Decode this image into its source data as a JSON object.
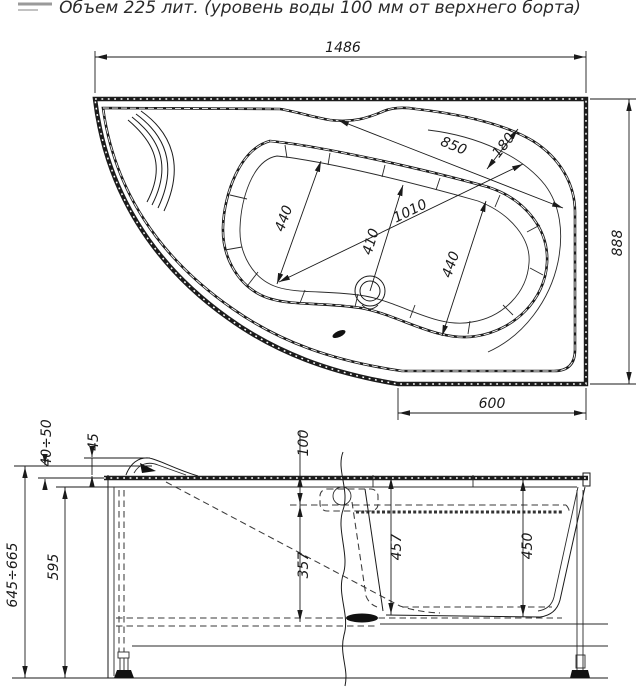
{
  "title": "Объем 225 лит. (уровень воды 100 мм от верхнего борта)",
  "top_view": {
    "dim_width": "1486",
    "dim_height": "888",
    "dim_bottom": "600",
    "dim_long_axis": "1010",
    "dim_diagonal": "850",
    "dim_rim": "180",
    "dim_upper_width": "440",
    "dim_lower_width": "440",
    "dim_drain": "410"
  },
  "side_view": {
    "dim_adjust_range": "40÷50",
    "dim_headrest": "45",
    "dim_water_level": "100",
    "dim_total_height": "645÷665",
    "dim_body_height": "595",
    "dim_depth_mid": "357",
    "dim_depth_full": "457",
    "dim_depth_right": "450"
  }
}
